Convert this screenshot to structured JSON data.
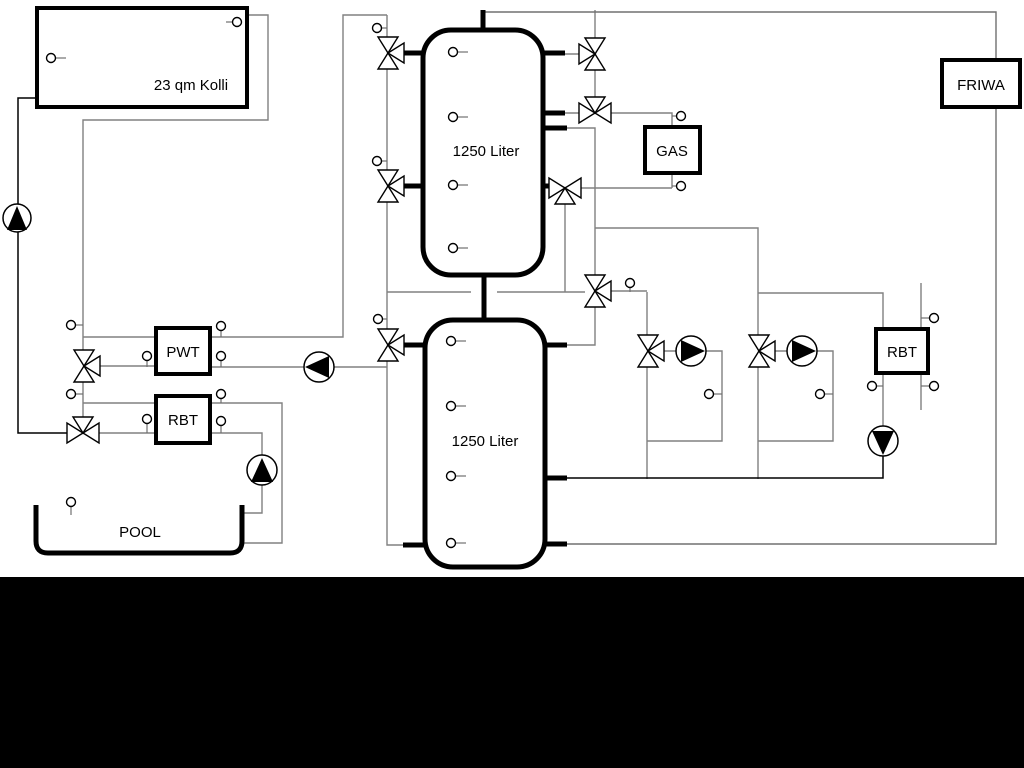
{
  "diagram": {
    "title_hint": "hydraulic heating scheme with solar collector, buffer tanks, gas boiler, pool and fresh water station",
    "collector_label": "23 qm Kolli",
    "upper_tank_label": "1250 Liter",
    "lower_tank_label": "1250 Liter",
    "pwt_label": "PWT",
    "rbt_left_label": "RBT",
    "gas_label": "GAS",
    "rbt_right_label": "RBT",
    "friwa_label": "FRIWA",
    "pool_label": "POOL",
    "colors": {
      "background": "#ffffff",
      "bottom_band": "#000000",
      "pipe_gray": "#808080",
      "pipe_black": "#000000"
    },
    "component_counts": {
      "pumps": 6,
      "three_way_valves": 11,
      "temperature_sensors": 25
    }
  }
}
